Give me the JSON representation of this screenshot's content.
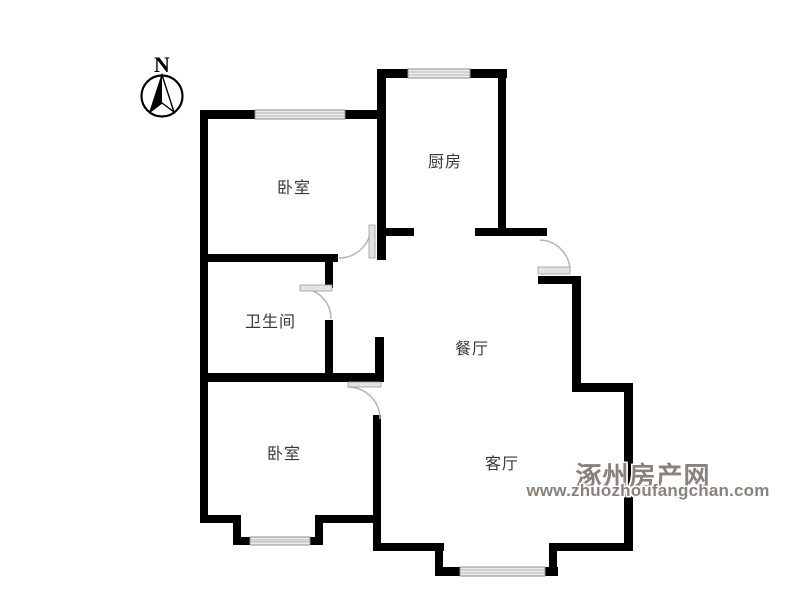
{
  "meta": {
    "background_color": "#ffffff",
    "wall_color": "#000000",
    "window_color": "#ededed",
    "door_arc_color": "#b5b5b5",
    "label_color": "#383838",
    "watermark_color": "#8a817b"
  },
  "compass": {
    "label": "N"
  },
  "rooms": [
    {
      "id": "bedroom-top",
      "label": "卧室"
    },
    {
      "id": "kitchen",
      "label": "厨房"
    },
    {
      "id": "bathroom",
      "label": "卫生间"
    },
    {
      "id": "dining",
      "label": "餐厅"
    },
    {
      "id": "living",
      "label": "客厅"
    },
    {
      "id": "bedroom-bottom",
      "label": "卧室"
    }
  ],
  "watermark": {
    "site_name": "涿州房产网",
    "site_url": "www.zhuozhoufangchan.com"
  }
}
